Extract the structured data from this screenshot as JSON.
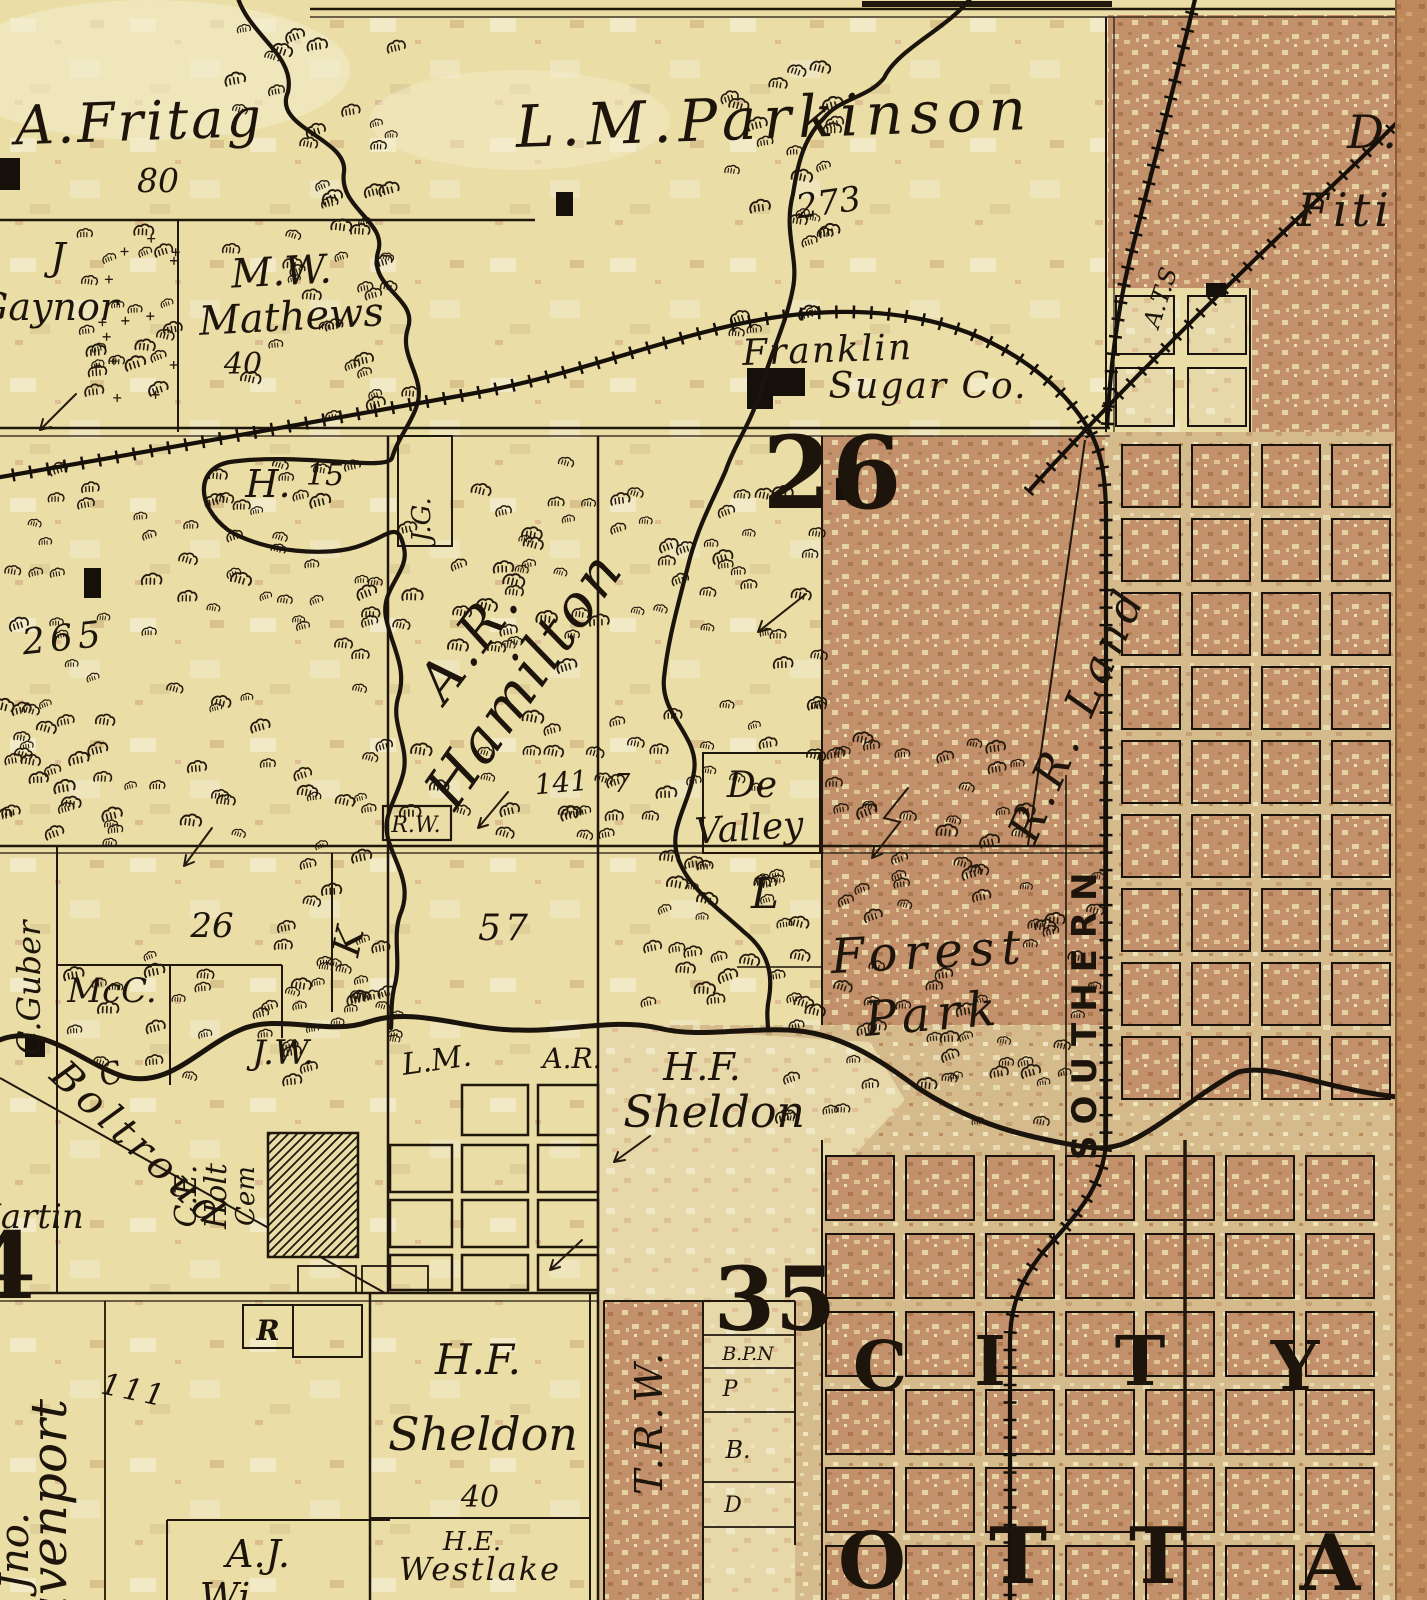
{
  "colors": {
    "paper": "#eadda5",
    "city_brown": "#c2906a",
    "light_tan": "#d5ba8c",
    "pale": "#e6d8a8",
    "ink": "#1b140c",
    "page_edge": "#bd885a"
  },
  "labels": {
    "fritag_name": "A.Fritag",
    "fritag_acres": "80",
    "gaynor_first": "J",
    "gaynor_last": "Gaynor",
    "mathews_first": "M.W.",
    "mathews_last": "Mathews",
    "mathews_acres": "40",
    "parkinson_name": "L.M.Parkinson",
    "parkinson_acres": "273",
    "fitch_first": "D.",
    "fitch_last": "Fiti",
    "franklin_line1": "Franklin",
    "franklin_line2": "Sugar Co.",
    "ats_rr": "A.T.S",
    "section_26": "26",
    "section_35": "35",
    "section_4": "4",
    "h_owner": "H.",
    "h_acres": "15",
    "jg": "J.G.",
    "acres_265": "265",
    "hamilton_first": "A.R.",
    "hamilton_last": "Hamilton",
    "hamilton_acres": "141",
    "hamilton_extra": "7",
    "rw": "R.W.",
    "de_valley_line1": "De",
    "de_valley_line2": "Valley",
    "l_parcel": "L",
    "forest_line1": "Forest",
    "forest_line2": "Park",
    "rr_land": "R.R. Land",
    "southern": "SOUTHERN",
    "guber": "C.Guber",
    "parcel_26": "26",
    "parcel_57": "57",
    "mcc": "McC.",
    "jw": "J.W.",
    "k": "K",
    "c_dot": "C.",
    "boltroud": "Boltroud",
    "martin": "Martin",
    "holt_line1": "C.E.",
    "holt_line2": "Holt",
    "holt_line3": "Cem",
    "r_box": "R",
    "davenport_first": "Jno.",
    "davenport_last": "Davenport",
    "davenport_acres": "111",
    "sheldon_mid_first": "H.F.",
    "sheldon_mid_last": "Sheldon",
    "lm": "L.M.",
    "ar": "A.R.",
    "trw": "T.R.W.",
    "bpn": "B.P.N",
    "p": "P",
    "b": "B.",
    "d": "D",
    "sheldon_bot_first": "H.F.",
    "sheldon_bot_last": "Sheldon",
    "sheldon_bot_acres": "40",
    "westlake_first": "H.E.",
    "westlake_last": "Westlake",
    "aj_first": "A.J.",
    "aj_last": "Wi",
    "city_letters": [
      "C",
      "I",
      "T",
      "Y"
    ],
    "otta_letters": [
      "O",
      "T",
      "T",
      "A"
    ]
  }
}
